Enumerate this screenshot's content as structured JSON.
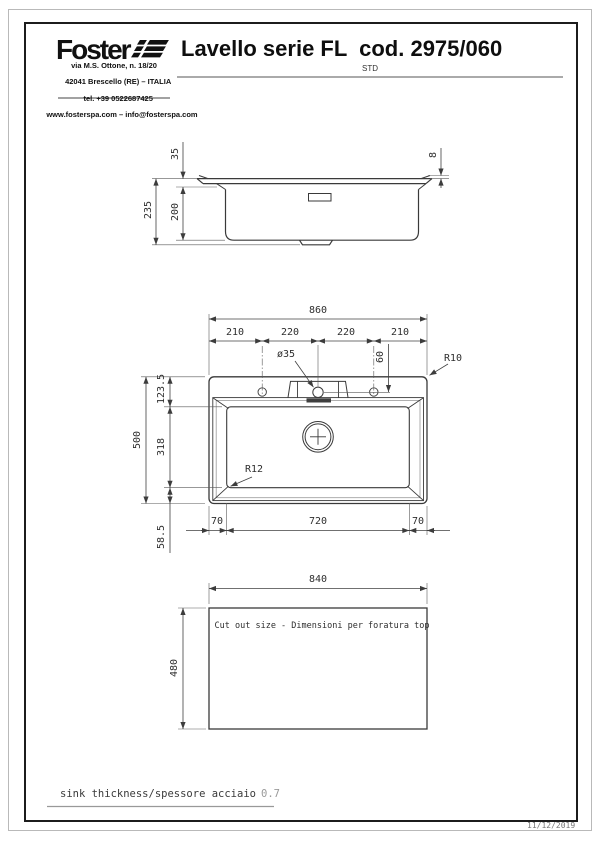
{
  "header": {
    "logo_text": "Foster",
    "address_lines": [
      "via M.S. Ottone, n. 18/20",
      "42041 Brescello (RE) – ITALIA",
      "tel. +39 0522687425",
      "www.fosterspa.com – info@fosterspa.com"
    ],
    "title": "Lavello serie FL  cod. 2975/060",
    "subtitle": "STD"
  },
  "side_view": {
    "dim_rim_height": "35",
    "dim_edge_height": "8",
    "dim_total_height": "235",
    "dim_bowl_depth": "200"
  },
  "plan_view": {
    "dim_total_width": "860",
    "dim_seg_1": "210",
    "dim_seg_2": "220",
    "dim_seg_3": "220",
    "dim_seg_4": "210",
    "dim_hole_diameter": "ø35",
    "dim_hole_offset": "60",
    "dim_corner_radius": "R10",
    "dim_top_ledge": "123.5",
    "dim_bowl_length": "318",
    "dim_total_depth": "500",
    "dim_bottom_ledge": "58.5",
    "dim_left_rim": "70",
    "dim_bowl_width": "720",
    "dim_right_rim": "70",
    "dim_bowl_radius": "R12"
  },
  "cutout_view": {
    "dim_width": "840",
    "dim_height": "480",
    "label": "Cut out size - Dimensioni per foratura top"
  },
  "footer": {
    "note_label": "sink thickness/spessore acciaio",
    "note_value": "0.7",
    "date": "11/12/2019"
  }
}
